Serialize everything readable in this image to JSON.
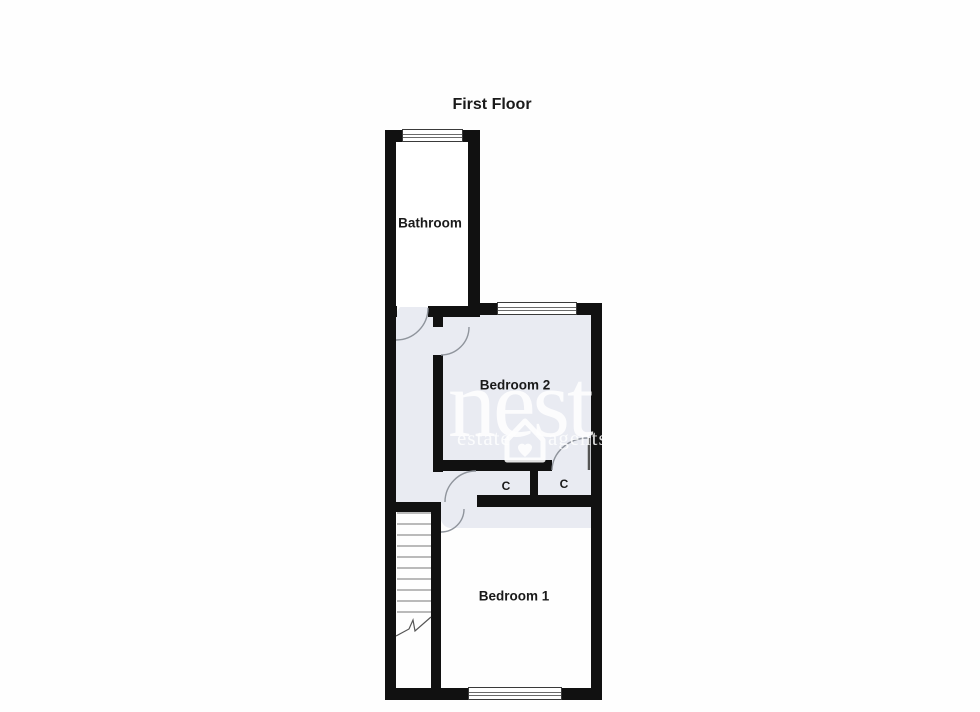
{
  "title": "First Floor",
  "rooms": {
    "bathroom": {
      "label": "Bathroom"
    },
    "bedroom2": {
      "label": "Bedroom 2"
    },
    "bedroom1": {
      "label": "Bedroom 1"
    },
    "closet_left": {
      "label": "C"
    },
    "closet_right": {
      "label": "C"
    }
  },
  "watermark": {
    "brand": "nest",
    "tagline_left": "estate",
    "tagline_right": "agents",
    "icon": "house-heart-icon"
  },
  "colors": {
    "wall": "#111111",
    "floor": "#ffffff",
    "tint": "#e9ebf2",
    "arc": "#8f949c",
    "label": "#1a1a1a",
    "watermark": "#ffffff"
  }
}
